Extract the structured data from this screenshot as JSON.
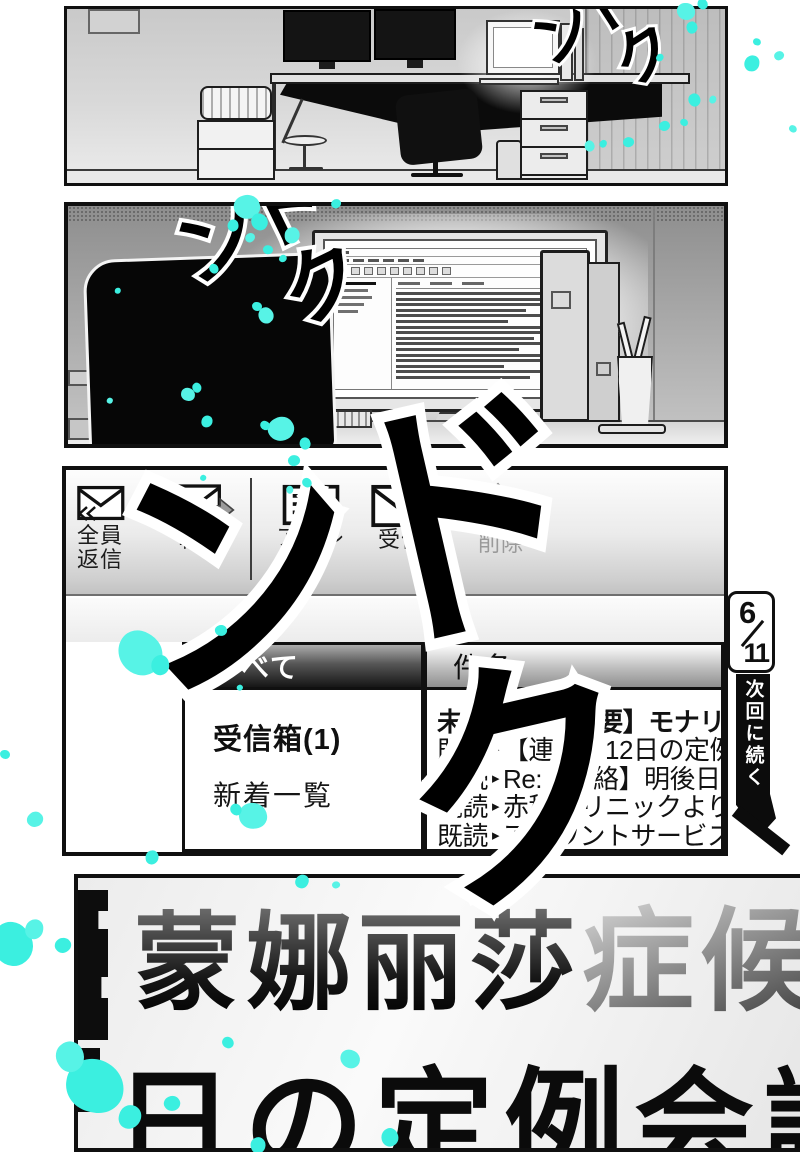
{
  "sfx": {
    "panel1": "ドクン",
    "panel2": "ドクン",
    "big": "ドクン"
  },
  "mail_app": {
    "toolbar": {
      "reply_all_line1": "全員",
      "reply_all_line2": "返信",
      "forward": "転送",
      "address": "アドレス",
      "receive": "受信",
      "delete": "削除"
    },
    "list": {
      "all_header": "すべて",
      "subject_header": "件名",
      "bullet": "▸",
      "folders": [
        {
          "name": "受信箱(1)"
        },
        {
          "name": "新着一覧"
        }
      ],
      "messages": [
        {
          "status": "未読",
          "subject": "Fw:【重要】モナリサ"
        },
        {
          "status": "既読",
          "subject": "【連絡】12日の定例"
        },
        {
          "status": "既読",
          "subject": "Re:【連絡】明後日"
        },
        {
          "status": "既読",
          "subject": "赤穂クリニックより"
        },
        {
          "status": "既読",
          "subject": "アカウントサービスを"
        }
      ]
    }
  },
  "page_marker": {
    "page": "6",
    "total": "11",
    "label": "次回に続く"
  },
  "title": {
    "part1": "蒙娜丽莎",
    "part2": "症候",
    "line2": "日の定例会議"
  },
  "colors": {
    "splatter": "#3BEFE0",
    "splatter_light": "#57F3E6"
  }
}
